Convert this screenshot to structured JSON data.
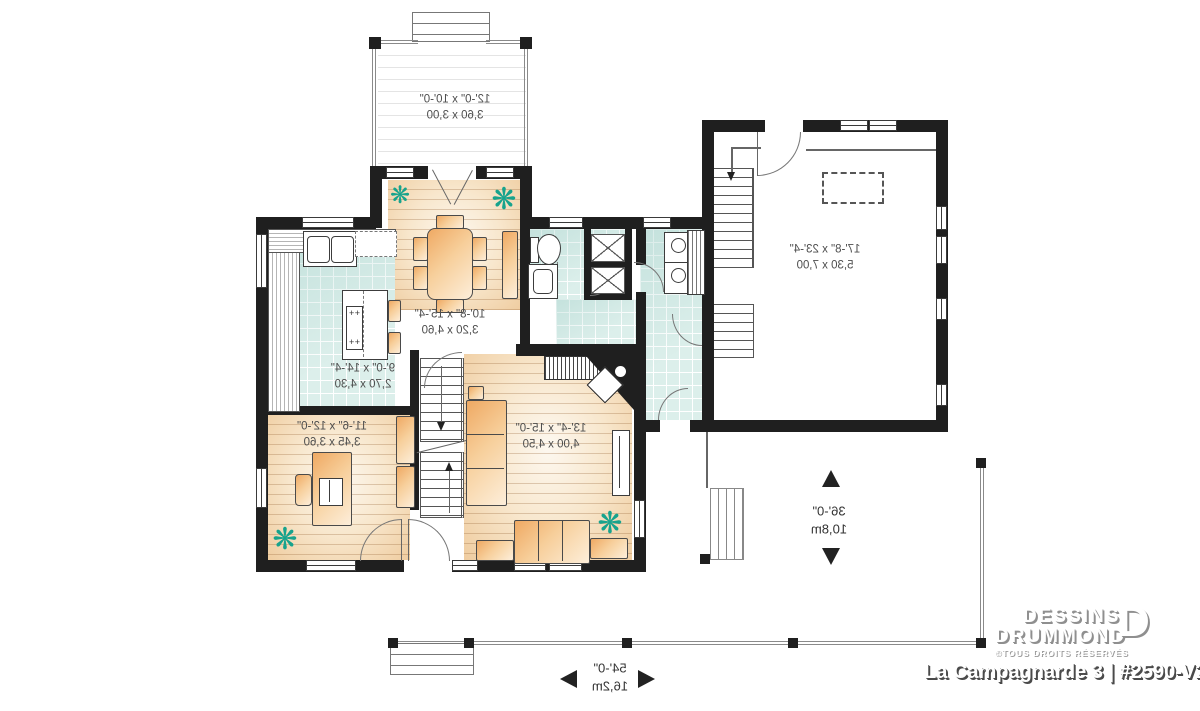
{
  "branding": {
    "name_line1": "DESSINS",
    "name_line2": "DRUMMOND",
    "rights": "©TOUS DROITS RÉSERVÉS",
    "plan_title": "La Campagnarde 3 | #2590-V2",
    "logo_letter": "D"
  },
  "rooms": {
    "deck": {
      "imperial": "12'-0\" x 10'-0\"",
      "metric": "3,60 x 3,00"
    },
    "dining": {
      "imperial": "10'-8\" x 15'-4\"",
      "metric": "3,20 x 4,60"
    },
    "kitchen": {
      "imperial": "9'-0\" x 14'-4\"",
      "metric": "2,70 x 4,30"
    },
    "office": {
      "imperial": "11'-6\" x 12'-0\"",
      "metric": "3,45 x 3,60"
    },
    "living": {
      "imperial": "13'-4\" x 15'-0\"",
      "metric": "4,00 x 4,50"
    },
    "garage": {
      "imperial": "17'-8\" x 23'-4\"",
      "metric": "5,30 x 7,00"
    }
  },
  "overall": {
    "width": {
      "imperial": "54'-0\"",
      "metric": "16,2m"
    },
    "depth": {
      "imperial": "36'-0\"",
      "metric": "10,8m"
    }
  },
  "colors": {
    "wall": "#1f1f1f",
    "tile": "#dcefeb",
    "wood_light": "#fdf8f0",
    "wood_dark": "#efcc9f",
    "furniture_light": "#fdeeda",
    "furniture_dark": "#efa963",
    "plant": "#17a38d",
    "dimension_text": "#4d4d4d"
  }
}
